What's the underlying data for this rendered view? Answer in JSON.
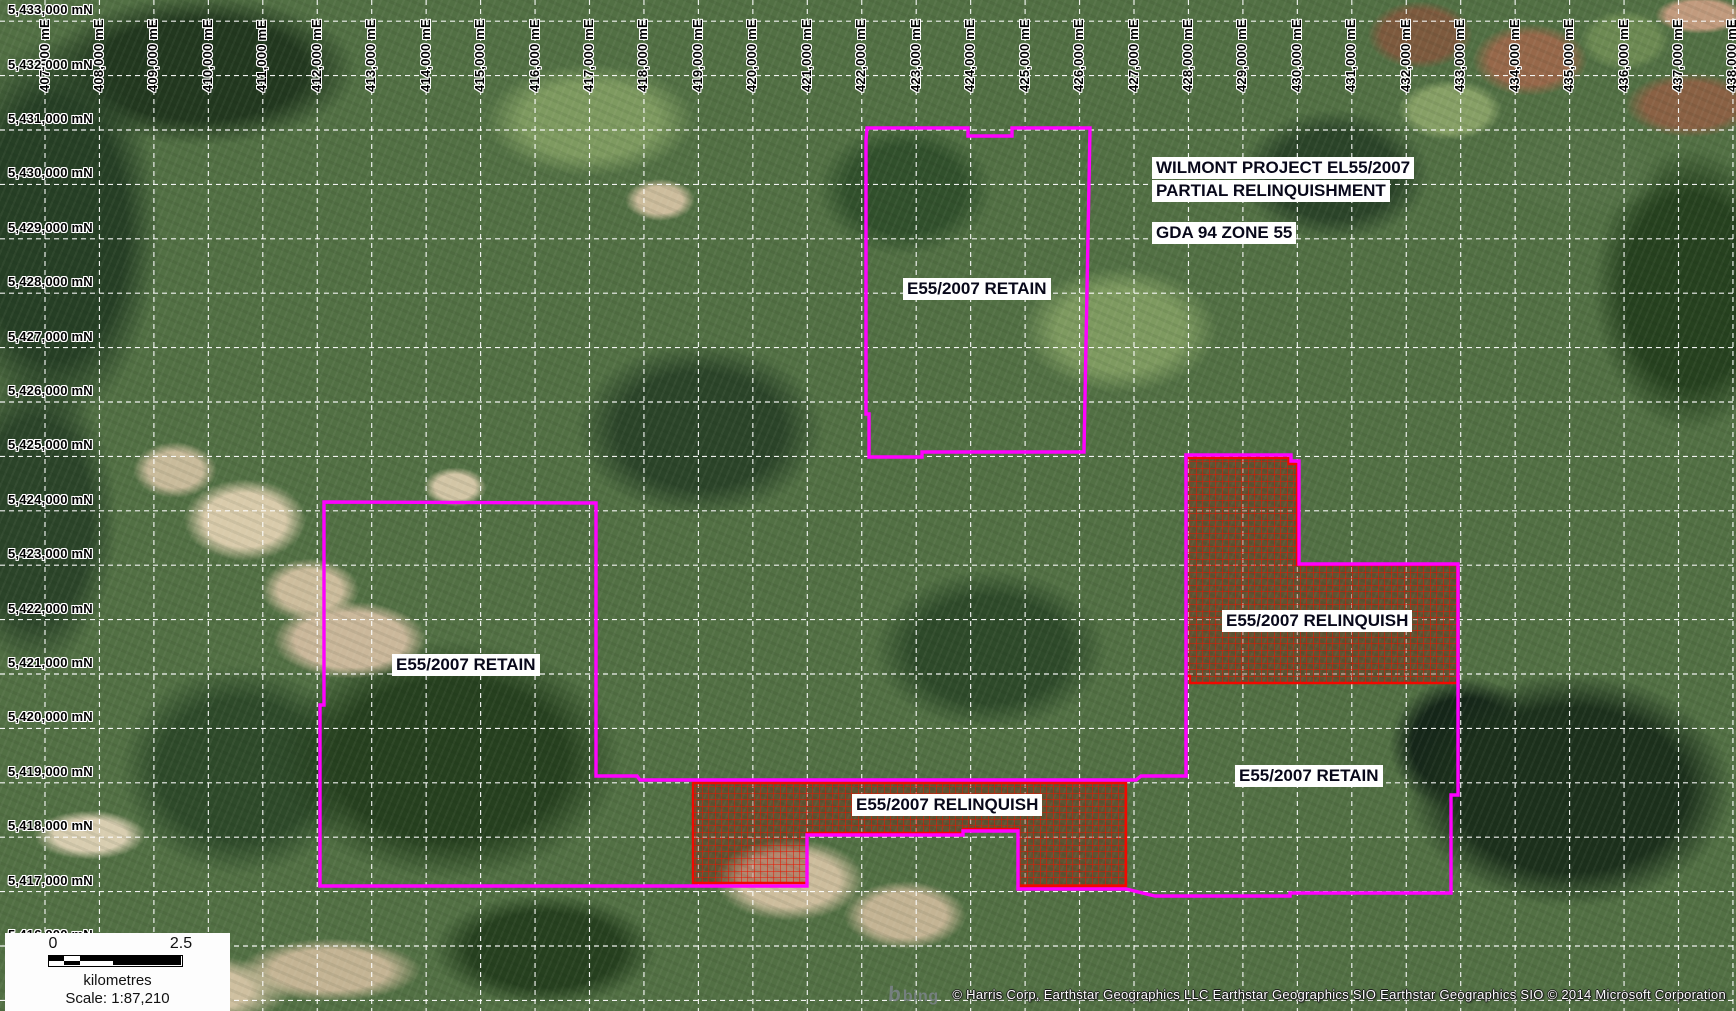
{
  "map": {
    "title": {
      "line1": "WILMONT PROJECT EL55/2007",
      "line2": "PARTIAL RELINQUISHMENT",
      "datum": "GDA 94 ZONE 55"
    },
    "feature_labels": [
      {
        "id": "label-retain-north",
        "text": "E55/2007 RETAIN",
        "x": 903,
        "y": 278
      },
      {
        "id": "label-retain-west",
        "text": "E55/2007 RETAIN",
        "x": 392,
        "y": 654
      },
      {
        "id": "label-relinquish-south",
        "text": "E55/2007 RELINQUISH",
        "x": 852,
        "y": 794
      },
      {
        "id": "label-relinquish-east",
        "text": "E55/2007 RELINQUISH",
        "x": 1222,
        "y": 610
      },
      {
        "id": "label-retain-east",
        "text": "E55/2007 RETAIN",
        "x": 1235,
        "y": 765
      }
    ],
    "grid": {
      "easting": {
        "x0": 45,
        "dx": 54.45,
        "labels": [
          "407,000 mE",
          "408,000 mE",
          "409,000 mE",
          "410,000 mE",
          "411,000 mE",
          "412,000 mE",
          "413,000 mE",
          "414,000 mE",
          "415,000 mE",
          "416,000 mE",
          "417,000 mE",
          "418,000 mE",
          "419,000 mE",
          "420,000 mE",
          "421,000 mE",
          "422,000 mE",
          "423,000 mE",
          "424,000 mE",
          "425,000 mE",
          "426,000 mE",
          "427,000 mE",
          "428,000 mE",
          "429,000 mE",
          "430,000 mE",
          "431,000 mE",
          "432,000 mE",
          "433,000 mE",
          "434,000 mE",
          "435,000 mE",
          "436,000 mE",
          "437,000 mE",
          "438,000 mE"
        ]
      },
      "northing": {
        "y0": 21.2,
        "dy": 54.4,
        "extra_unlabeled_lines": 1,
        "labels": [
          "5,433,000 mN",
          "5,432,000 mN",
          "5,431,000 mN",
          "5,430,000 mN",
          "5,429,000 mN",
          "5,428,000 mN",
          "5,427,000 mN",
          "5,426,000 mN",
          "5,425,000 mN",
          "5,424,000 mN",
          "5,423,000 mN",
          "5,422,000 mN",
          "5,421,000 mN",
          "5,420,000 mN",
          "5,419,000 mN",
          "5,418,000 mN",
          "5,417,000 mN",
          "5,416,000 mN"
        ]
      }
    },
    "boundaries": {
      "colors": {
        "retain_boundary": "#ff00ff",
        "relinquish_boundary": "#f20800",
        "grid": "#ffffff"
      },
      "shapes": [
        {
          "id": "relinquish-area-south",
          "type": "red",
          "points": [
            [
              693,
              783
            ],
            [
              1126,
              783
            ],
            [
              1126,
              886
            ],
            [
              1018,
              886
            ],
            [
              1018,
              829
            ],
            [
              963,
              829
            ],
            [
              963,
              833
            ],
            [
              807,
              833
            ],
            [
              807,
              883
            ],
            [
              693,
              883
            ]
          ]
        },
        {
          "id": "relinquish-area-east",
          "type": "red",
          "points": [
            [
              1189,
              458
            ],
            [
              1289,
              458
            ],
            [
              1289,
              464
            ],
            [
              1297,
              464
            ],
            [
              1297,
              565
            ],
            [
              1458,
              565
            ],
            [
              1458,
              683
            ],
            [
              1190,
              683
            ],
            [
              1190,
              676
            ],
            [
              1186,
              676
            ],
            [
              1186,
              458
            ]
          ]
        },
        {
          "id": "boundary-retain-north",
          "type": "magenta",
          "points": [
            [
              867,
              128
            ],
            [
              968,
              128
            ],
            [
              968,
              136
            ],
            [
              1012,
              136
            ],
            [
              1012,
              128
            ],
            [
              1090,
              128
            ],
            [
              1084,
              452
            ],
            [
              922,
              452
            ],
            [
              922,
              457
            ],
            [
              869,
              457
            ],
            [
              869,
              414
            ],
            [
              866,
              414
            ],
            [
              866,
              140
            ]
          ]
        },
        {
          "id": "boundary-el-main",
          "type": "magenta",
          "points": [
            [
              324,
              502
            ],
            [
              596,
              503
            ],
            [
              596,
              776
            ],
            [
              637,
              776
            ],
            [
              640,
              780
            ],
            [
              1136,
              780
            ],
            [
              1141,
              776
            ],
            [
              1186,
              776
            ],
            [
              1186,
              455
            ],
            [
              1291,
              455
            ],
            [
              1291,
              461
            ],
            [
              1299,
              461
            ],
            [
              1299,
              564
            ],
            [
              1458,
              564
            ],
            [
              1458,
              795
            ],
            [
              1451,
              795
            ],
            [
              1451,
              893
            ],
            [
              1290,
              893
            ],
            [
              1290,
              896
            ],
            [
              1155,
              896
            ],
            [
              1126,
              889
            ],
            [
              1018,
              889
            ],
            [
              1018,
              831
            ],
            [
              963,
              831
            ],
            [
              963,
              835
            ],
            [
              807,
              835
            ],
            [
              807,
              886
            ],
            [
              320,
              886
            ],
            [
              320,
              705
            ],
            [
              324,
              705
            ]
          ]
        }
      ]
    },
    "scalebar": {
      "left_value": "0",
      "right_value": "2.5",
      "units": "kilometres",
      "scale_text": "Scale: 1:87,210",
      "segment_widths": [
        15,
        16,
        33,
        68
      ],
      "top_colors": [
        "#000000",
        "#ffffff",
        "#000000",
        "#000000"
      ],
      "bottom_colors": [
        "#ffffff",
        "#000000",
        "#ffffff",
        "#000000"
      ]
    },
    "attribution": {
      "bing_icon": "b",
      "bing": "bing",
      "credits": "© Harris Corp, Earthstar Geographics LLC Earthstar Geographics SIO Earthstar Geographics SIO © 2014 Microsoft Corporation"
    }
  }
}
